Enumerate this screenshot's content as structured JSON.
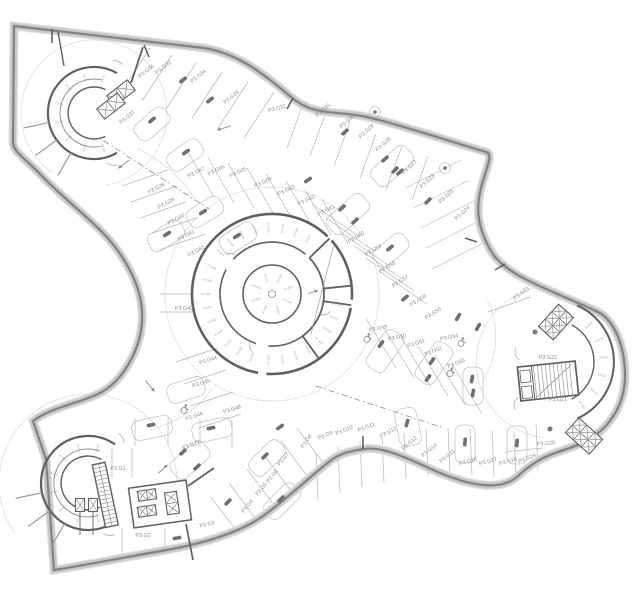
{
  "meta": {
    "title": "Parking level P3 floor plan",
    "type": "architectural-floor-plan",
    "level_prefix": "P3"
  },
  "colors": {
    "background": "#ffffff",
    "wall_band": "#c8c8c8",
    "wall_line": "#828282",
    "core_wall": "#5f5f5f",
    "thin_line": "#b5b5b5",
    "faint_line": "#e2e2e2",
    "label_text": "#8d8d8d",
    "tiny_text": "#9b9b9b",
    "column_fill": "#6f6f6f"
  },
  "stall_labels": [
    {
      "text": "P3.G1",
      "x": 118,
      "y": 468,
      "rot": 0
    },
    {
      "text": "P3.G2",
      "x": 143,
      "y": 535,
      "rot": 0
    },
    {
      "text": "P3.G3",
      "x": 207,
      "y": 524,
      "rot": -12
    },
    {
      "text": "P3.G4",
      "x": 247,
      "y": 506,
      "rot": -52
    },
    {
      "text": "P3.G5",
      "x": 261,
      "y": 489,
      "rot": -52
    },
    {
      "text": "P3.G6",
      "x": 272,
      "y": 476,
      "rot": -52
    },
    {
      "text": "P3.G7",
      "x": 283,
      "y": 459,
      "rot": -52
    },
    {
      "text": "P3.G8",
      "x": 306,
      "y": 441,
      "rot": -55
    },
    {
      "text": "P3.G9",
      "x": 325,
      "y": 435,
      "rot": -22
    },
    {
      "text": "P3.G10",
      "x": 344,
      "y": 430,
      "rot": -22
    },
    {
      "text": "P3.G11",
      "x": 366,
      "y": 427,
      "rot": -22
    },
    {
      "text": "P3.G12",
      "x": 388,
      "y": 432,
      "rot": -28
    },
    {
      "text": "P3.G13",
      "x": 409,
      "y": 443,
      "rot": -40
    },
    {
      "text": "P3.G14",
      "x": 429,
      "y": 450,
      "rot": -38
    },
    {
      "text": "P3.G15",
      "x": 447,
      "y": 456,
      "rot": -38
    },
    {
      "text": "P3.G16",
      "x": 468,
      "y": 461,
      "rot": -15
    },
    {
      "text": "P3.G17",
      "x": 488,
      "y": 461,
      "rot": -15
    },
    {
      "text": "P3.G18",
      "x": 508,
      "y": 461,
      "rot": -15
    },
    {
      "text": "P3.G19",
      "x": 527,
      "y": 458,
      "rot": -22
    },
    {
      "text": "P3.G20",
      "x": 546,
      "y": 443,
      "rot": -5
    },
    {
      "text": "P3.G21",
      "x": 558,
      "y": 399,
      "rot": 0
    },
    {
      "text": "P3.G22",
      "x": 548,
      "y": 357,
      "rot": 0
    },
    {
      "text": "P3.G23",
      "x": 521,
      "y": 293,
      "rot": -38
    },
    {
      "text": "P3.G24",
      "x": 462,
      "y": 213,
      "rot": -42
    },
    {
      "text": "P3.G25",
      "x": 446,
      "y": 196,
      "rot": -42
    },
    {
      "text": "P3.G26",
      "x": 427,
      "y": 181,
      "rot": -42
    },
    {
      "text": "P3.G27",
      "x": 409,
      "y": 167,
      "rot": -42
    },
    {
      "text": "P3.G28",
      "x": 383,
      "y": 144,
      "rot": -42
    },
    {
      "text": "P3.G29",
      "x": 366,
      "y": 131,
      "rot": -42
    },
    {
      "text": "P3.G30",
      "x": 347,
      "y": 121,
      "rot": -42
    },
    {
      "text": "P3.G31",
      "x": 323,
      "y": 110,
      "rot": -42
    },
    {
      "text": "P3.G32",
      "x": 277,
      "y": 108,
      "rot": -15
    },
    {
      "text": "P3.G33",
      "x": 231,
      "y": 97,
      "rot": -38
    },
    {
      "text": "P3.G34",
      "x": 198,
      "y": 76,
      "rot": -38
    },
    {
      "text": "P3.G35",
      "x": 163,
      "y": 67,
      "rot": -38
    },
    {
      "text": "P3.G36",
      "x": 146,
      "y": 71,
      "rot": -38
    },
    {
      "text": "P3.G37",
      "x": 127,
      "y": 117,
      "rot": -38
    },
    {
      "text": "P3.G38",
      "x": 156,
      "y": 188,
      "rot": -28
    },
    {
      "text": "P3.G39",
      "x": 166,
      "y": 203,
      "rot": -28
    },
    {
      "text": "P3.G40",
      "x": 176,
      "y": 219,
      "rot": -28
    },
    {
      "text": "P3.G41",
      "x": 186,
      "y": 235,
      "rot": -28
    },
    {
      "text": "P3.G42",
      "x": 196,
      "y": 251,
      "rot": -28
    },
    {
      "text": "P3.G43",
      "x": 184,
      "y": 308,
      "rot": 0
    },
    {
      "text": "P3.G44",
      "x": 208,
      "y": 360,
      "rot": -18
    },
    {
      "text": "P3.G45",
      "x": 201,
      "y": 383,
      "rot": -18
    },
    {
      "text": "P3.G46",
      "x": 194,
      "y": 416,
      "rot": -18
    },
    {
      "text": "P3.G47",
      "x": 191,
      "y": 445,
      "rot": -18
    },
    {
      "text": "P3.G48",
      "x": 232,
      "y": 409,
      "rot": -18
    },
    {
      "text": "P3.G49",
      "x": 378,
      "y": 328,
      "rot": -12
    },
    {
      "text": "P3.G50",
      "x": 397,
      "y": 337,
      "rot": -12
    },
    {
      "text": "P3.G51",
      "x": 416,
      "y": 343,
      "rot": -18
    },
    {
      "text": "P3.G52",
      "x": 433,
      "y": 351,
      "rot": -22
    },
    {
      "text": "P3.G53",
      "x": 456,
      "y": 363,
      "rot": -22
    },
    {
      "text": "P3.G54",
      "x": 449,
      "y": 337,
      "rot": -12
    },
    {
      "text": "P3.G55",
      "x": 433,
      "y": 313,
      "rot": -32
    },
    {
      "text": "P3.G56",
      "x": 418,
      "y": 300,
      "rot": -32
    },
    {
      "text": "P3.G57",
      "x": 400,
      "y": 281,
      "rot": -32
    },
    {
      "text": "P3.G58",
      "x": 387,
      "y": 267,
      "rot": -32
    },
    {
      "text": "P3.G59",
      "x": 373,
      "y": 250,
      "rot": -32
    },
    {
      "text": "P3.G60",
      "x": 356,
      "y": 237,
      "rot": -32
    },
    {
      "text": "P3.G61",
      "x": 326,
      "y": 210,
      "rot": -26
    },
    {
      "text": "P3.G62",
      "x": 306,
      "y": 200,
      "rot": -26
    },
    {
      "text": "P3.G63",
      "x": 286,
      "y": 190,
      "rot": -26
    },
    {
      "text": "P3.G64",
      "x": 263,
      "y": 182,
      "rot": -26
    },
    {
      "text": "P3.G65",
      "x": 238,
      "y": 172,
      "rot": -26
    },
    {
      "text": "P3.G66",
      "x": 216,
      "y": 170,
      "rot": -26
    },
    {
      "text": "P3.G67",
      "x": 196,
      "y": 172,
      "rot": -26
    }
  ],
  "tiny_label_groups": [
    {
      "name": "core-ring-top",
      "center": [
        272,
        294
      ],
      "radius": 66,
      "start": 57,
      "step": 12,
      "texts": [
        "P3.S47",
        "P3.S48",
        "P3.S49",
        "P3.S50",
        "P3.S51",
        "P3.S52",
        "P3.S53",
        "P3.S54"
      ]
    },
    {
      "name": "core-ring-left",
      "center": [
        272,
        294
      ],
      "radius": 66,
      "start": 156,
      "step": 12,
      "texts": [
        "P3.S38",
        "P3.S39",
        "P3.S40",
        "P3.S41",
        "P3.S42",
        "P3.S43",
        "P3.S44",
        "P3.S45",
        "P3.S46"
      ]
    },
    {
      "name": "core-ring-bottom",
      "center": [
        272,
        294
      ],
      "radius": 66,
      "start": 267,
      "step": 12,
      "texts": [
        "P3.S29",
        "P3.S30",
        "P3.S31",
        "P3.S32",
        "P3.S33",
        "P3.S34",
        "P3.S35",
        "P3.S36"
      ]
    },
    {
      "name": "core-inner",
      "center": [
        272,
        294
      ],
      "radius": 17,
      "start": 20,
      "step": 45,
      "texts": [
        "P3.S55",
        "P3.S56",
        "P3.S57",
        "P3.S58",
        "P3.S59",
        "P3.S60",
        "P3.S61",
        "P3.S62"
      ]
    },
    {
      "name": "topleft-core",
      "center": [
        94,
        113
      ],
      "radius": 36,
      "start": 75,
      "step": 30,
      "texts": [
        "P3.S1",
        "P3.S2",
        "P3.S3",
        "P3.S4",
        "P3.S5",
        "P3.S6",
        "P3.S7",
        "P3.S8"
      ]
    },
    {
      "name": "bottomleft-core",
      "center": [
        88,
        483
      ],
      "radius": 36,
      "start": 75,
      "step": 30,
      "texts": [
        "P3.S9",
        "P3.S10",
        "P3.S11",
        "P3.S12",
        "P3.S13",
        "P3.S14",
        "P3.S15",
        "P3.S16"
      ]
    },
    {
      "name": "right-core",
      "center": [
        552,
        362
      ],
      "radius": 52,
      "start": -55,
      "step": 20,
      "texts": [
        "P3.S20",
        "P3.S21",
        "P3.S22",
        "P3.S23",
        "P3.S24",
        "P3.S25"
      ]
    }
  ]
}
